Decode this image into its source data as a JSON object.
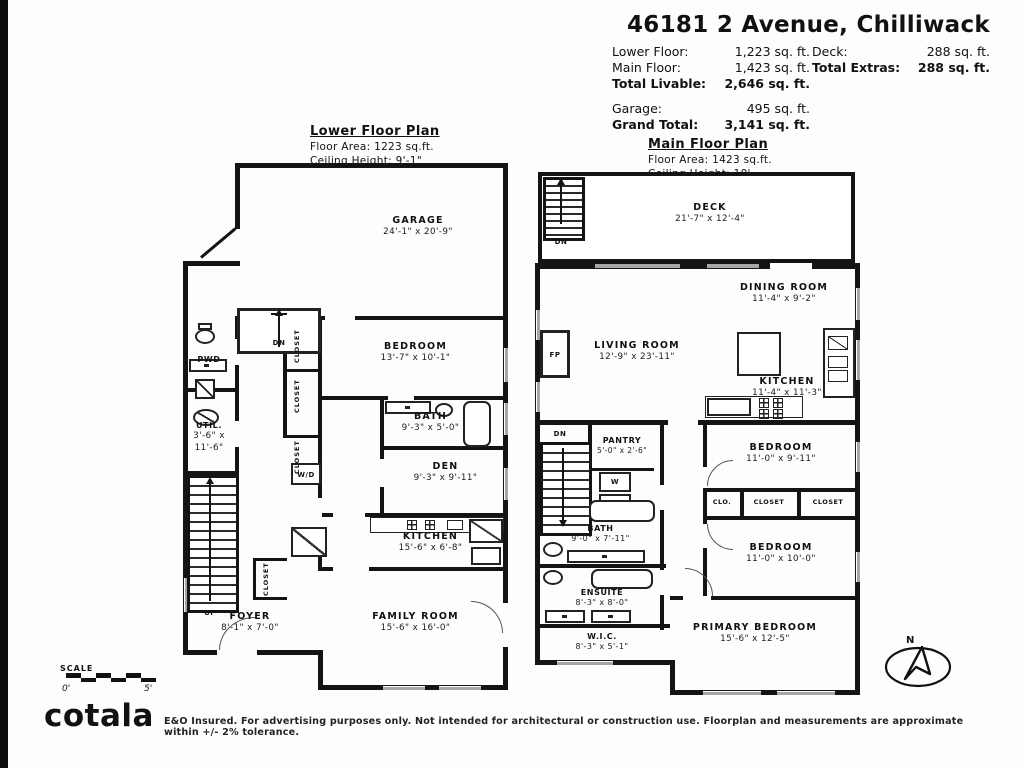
{
  "header": {
    "title": "46181 2 Avenue, Chilliwack",
    "stats": {
      "lower_floor": {
        "label": "Lower Floor:",
        "value": "1,223 sq. ft."
      },
      "main_floor": {
        "label": "Main Floor:",
        "value": "1,423 sq. ft."
      },
      "total_livable": {
        "label": "Total Livable:",
        "value": "2,646 sq. ft."
      },
      "deck": {
        "label": "Deck:",
        "value": "288 sq. ft."
      },
      "total_extras": {
        "label": "Total Extras:",
        "value": "288 sq. ft."
      },
      "garage": {
        "label": "Garage:",
        "value": "495 sq. ft."
      },
      "grand_total": {
        "label": "Grand Total:",
        "value": "3,141 sq. ft."
      }
    }
  },
  "lower_plan": {
    "title": "Lower Floor Plan",
    "floor_area": "Floor Area: 1223 sq.ft.",
    "ceiling_height": "Ceiling Height: 9'-1\"",
    "rooms": {
      "garage": {
        "name": "GARAGE",
        "dims": "24'-1\" x 20'-9\""
      },
      "pwd": {
        "name": "PWD"
      },
      "util": {
        "name": "UTIL.",
        "dims": "3'-6\" x 11'-6\""
      },
      "bedroom": {
        "name": "BEDROOM",
        "dims": "13'-7\" x 10'-1\""
      },
      "bath": {
        "name": "BATH",
        "dims": "9'-3\" x 5'-0\""
      },
      "den": {
        "name": "DEN",
        "dims": "9'-3\" x 9'-11\""
      },
      "kitchen": {
        "name": "KITCHEN",
        "dims": "15'-6\" x 6'-8\""
      },
      "foyer": {
        "name": "FOYER",
        "dims": "8'-1\" x 7'-0\""
      },
      "family_room": {
        "name": "FAMILY ROOM",
        "dims": "15'-6\" x 16'-0\""
      }
    },
    "labels": {
      "dn": "DN",
      "up": "UP",
      "wd": "W/D",
      "closet": "CLOSET"
    }
  },
  "main_plan": {
    "title": "Main Floor Plan",
    "floor_area": "Floor Area: 1423 sq.ft.",
    "ceiling_height": "Ceiling Height: 10'",
    "rooms": {
      "deck": {
        "name": "DECK",
        "dims": "21'-7\" x 12'-4\""
      },
      "dining": {
        "name": "DINING ROOM",
        "dims": "11'-4\" x 9'-2\""
      },
      "living": {
        "name": "LIVING ROOM",
        "dims": "12'-9\" x 23'-11\""
      },
      "kitchen": {
        "name": "KITCHEN",
        "dims": "11'-4\" x 11'-3\""
      },
      "pantry": {
        "name": "PANTRY",
        "dims": "5'-0\" x 2'-6\""
      },
      "bath": {
        "name": "BATH",
        "dims": "9'-0\" x 7'-11\""
      },
      "bedroom_upper": {
        "name": "BEDROOM",
        "dims": "11'-0\" x 9'-11\""
      },
      "bedroom_lower": {
        "name": "BEDROOM",
        "dims": "11'-0\" x 10'-0\""
      },
      "ensuite": {
        "name": "ENSUITE",
        "dims": "8'-3\" x 8'-0\""
      },
      "wic": {
        "name": "W.I.C.",
        "dims": "8'-3\" x 5'-1\""
      },
      "primary": {
        "name": "PRIMARY BEDROOM",
        "dims": "15'-6\" x 12'-5\""
      }
    },
    "labels": {
      "dn": "DN",
      "fp": "FP",
      "w": "W",
      "d": "D",
      "clo": "CLO.",
      "closet": "CLOSET"
    }
  },
  "scale_bar": {
    "label": "SCALE",
    "start": "0'",
    "end": "5'"
  },
  "compass": {
    "north": "N"
  },
  "footer": {
    "logo": "cotala",
    "disclaimer": "E&O Insured. For advertising purposes only. Not intended for architectural or construction use. Floorplan and measurements are approximate within +/- 2% tolerance."
  }
}
